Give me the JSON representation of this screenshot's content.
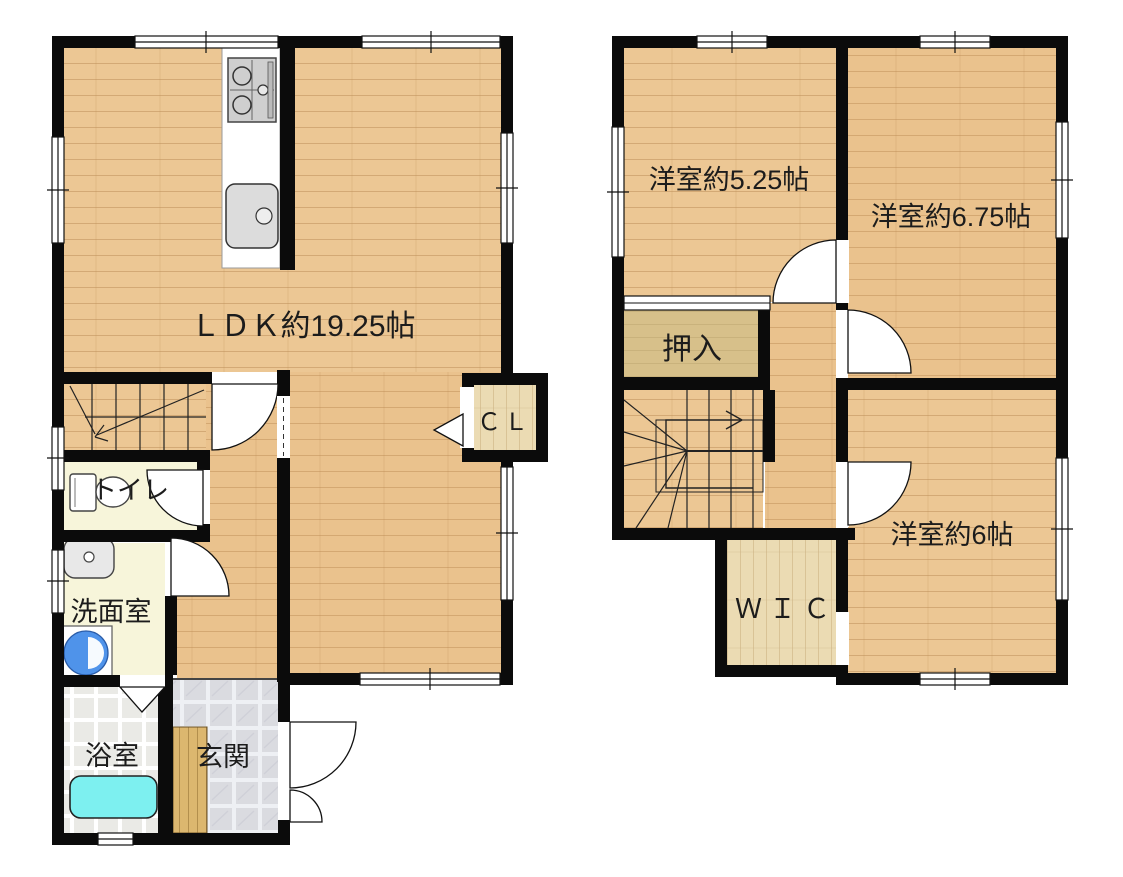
{
  "plan": {
    "floor1": {
      "ldk_label": "ＬＤＫ約19.25帖",
      "toilet_label": "トイレ",
      "washroom_label": "洗面室",
      "bathroom_label": "浴室",
      "entrance_label": "玄関",
      "closet_label": "ＣＬ"
    },
    "floor2": {
      "room525_label": "洋室約5.25帖",
      "room675_label": "洋室約6.75帖",
      "room6_label": "洋室約6帖",
      "oshiire_label": "押入",
      "wic_label": "ＷＩＣ"
    },
    "colors": {
      "wall": "#0b0b0b",
      "wood_floor": "#ecc794",
      "oshiire_floor": "#d7c08a",
      "wic_floor": "#ebdbb3",
      "cream_floor": "#f7f5da",
      "bath_tile": "#eaeae6",
      "entrance_marble": "#dadbe0",
      "step_wood": "#dcb76f",
      "bathtub": "#7df0f0",
      "washer": "#4f93ea"
    }
  }
}
